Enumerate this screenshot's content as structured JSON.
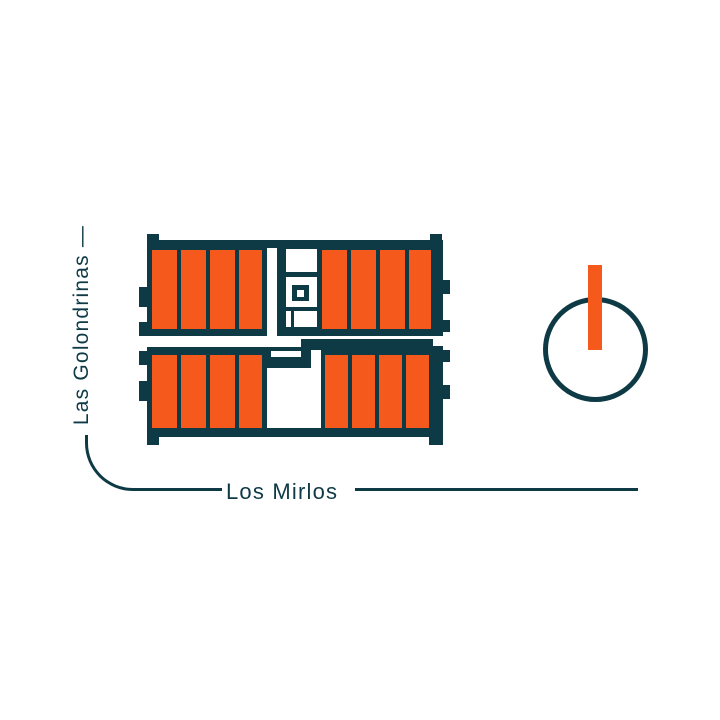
{
  "title": "Residential site plan",
  "streets": {
    "left": {
      "label": "Las Golondrinas —"
    },
    "bottom": {
      "label": "Los Mirlos"
    }
  },
  "building": {
    "unit_count": 16,
    "unit_blocks": [
      {
        "id": "top-left",
        "units": 4
      },
      {
        "id": "top-right",
        "units": 4
      },
      {
        "id": "bottom-left",
        "units": 4
      },
      {
        "id": "bottom-right",
        "units": 4
      }
    ]
  },
  "north_indicator": {
    "shape": "circle with orange bar pointing up"
  },
  "colors": {
    "outline": "#0e3a46",
    "unit_fill": "#f5591b",
    "background": "#ffffff"
  }
}
